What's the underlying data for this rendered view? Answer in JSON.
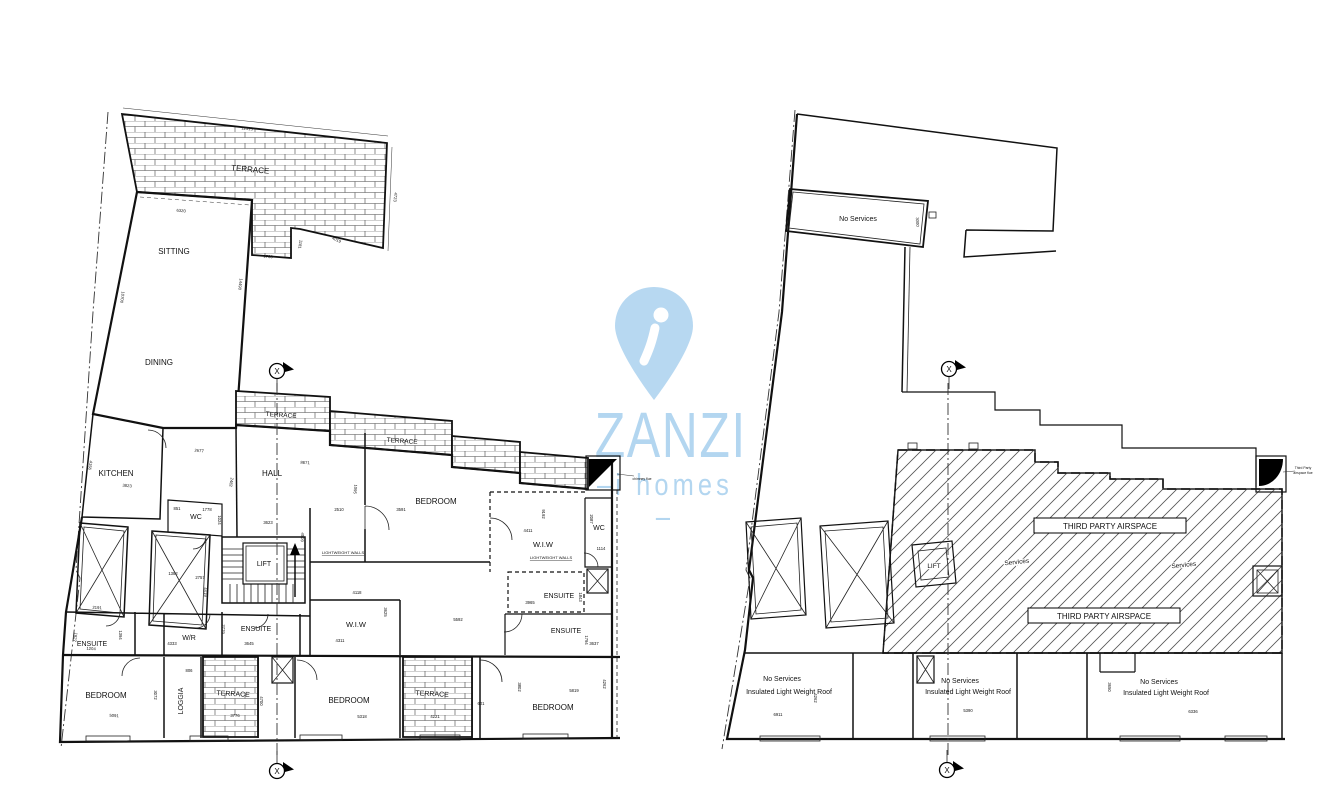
{
  "section_marker_label": "X",
  "watermark": {
    "brand": "ZANZI",
    "tagline_left": "–i",
    "tagline_word": "homes",
    "tagline_right": "–",
    "color": "#b3d6f0"
  },
  "left_plan": {
    "title": "penthouse floor plan",
    "rooms": [
      {
        "label": "TERRACE",
        "x": 250,
        "y": 172,
        "fs": 8,
        "rot": 5
      },
      {
        "label": "SITTING",
        "x": 174,
        "y": 254,
        "fs": 8
      },
      {
        "label": "DINING",
        "x": 159,
        "y": 365,
        "fs": 8
      },
      {
        "label": "KITCHEN",
        "x": 116,
        "y": 476,
        "fs": 8
      },
      {
        "label": "WC",
        "x": 196,
        "y": 519,
        "fs": 7
      },
      {
        "label": "HALL",
        "x": 272,
        "y": 476,
        "fs": 8
      },
      {
        "label": "LIFT",
        "x": 264,
        "y": 566,
        "fs": 7
      },
      {
        "label": "TERRACE",
        "x": 281,
        "y": 417,
        "fs": 6.5,
        "rot": 4
      },
      {
        "label": "TERRACE",
        "x": 402,
        "y": 443,
        "fs": 6.5,
        "rot": 4
      },
      {
        "label": "BEDROOM",
        "x": 436,
        "y": 504,
        "fs": 8
      },
      {
        "label": "W.I.W",
        "x": 543,
        "y": 547,
        "fs": 7.5
      },
      {
        "label": "WC",
        "x": 599,
        "y": 530,
        "fs": 7
      },
      {
        "label": "ENSUITE",
        "x": 559,
        "y": 598,
        "fs": 7
      },
      {
        "label": "ENSUITE",
        "x": 566,
        "y": 633,
        "fs": 7
      },
      {
        "label": "W.I.W",
        "x": 356,
        "y": 627,
        "fs": 7.5
      },
      {
        "label": "ENSUITE",
        "x": 256,
        "y": 631,
        "fs": 7
      },
      {
        "label": "W/R",
        "x": 189,
        "y": 640,
        "fs": 7
      },
      {
        "label": "ENSUITE",
        "x": 92,
        "y": 646,
        "fs": 7
      },
      {
        "label": "BEDROOM",
        "x": 106,
        "y": 698,
        "fs": 8
      },
      {
        "label": "LOGGIA",
        "x": 183,
        "y": 701,
        "fs": 7,
        "rot": -90
      },
      {
        "label": "TERRACE",
        "x": 233,
        "y": 696,
        "fs": 7,
        "rot": 3
      },
      {
        "label": "BEDROOM",
        "x": 349,
        "y": 703,
        "fs": 8
      },
      {
        "label": "TERRACE",
        "x": 432,
        "y": 696,
        "fs": 7,
        "rot": 3
      },
      {
        "label": "BEDROOM",
        "x": 553,
        "y": 710,
        "fs": 8
      }
    ],
    "tiny_labels": [
      {
        "label": "LIGHTWEIGHT WALLS",
        "x": 551,
        "y": 559,
        "fs": 4,
        "cls": "underline"
      },
      {
        "label": "LIGHTWEIGHT WALLS",
        "x": 343,
        "y": 554,
        "fs": 4,
        "cls": "underline"
      },
      {
        "label": "chimney flue",
        "x": 642,
        "y": 480,
        "fs": 3.4
      }
    ],
    "dimensions": [
      {
        "label": "12515",
        "x": 247,
        "y": 130,
        "rot": 5
      },
      {
        "label": "4723",
        "x": 394,
        "y": 197,
        "rot": 95
      },
      {
        "label": "6320",
        "x": 181,
        "y": 212,
        "rot": 5
      },
      {
        "label": "14490",
        "x": 239,
        "y": 284,
        "rot": 97
      },
      {
        "label": "10700",
        "x": 121,
        "y": 297,
        "rot": 98
      },
      {
        "label": "1730",
        "x": 268,
        "y": 258,
        "rot": 4
      },
      {
        "label": "1181",
        "x": 299,
        "y": 244,
        "rot": 100
      },
      {
        "label": "4019",
        "x": 336,
        "y": 241,
        "rot": 25
      },
      {
        "label": "2677",
        "x": 199,
        "y": 452,
        "rot": 5
      },
      {
        "label": "2482",
        "x": 230,
        "y": 482,
        "rot": 100
      },
      {
        "label": "8671",
        "x": 305,
        "y": 464,
        "rot": 3
      },
      {
        "label": "1095",
        "x": 354,
        "y": 489,
        "rot": 95
      },
      {
        "label": "2510",
        "x": 339,
        "y": 511
      },
      {
        "label": "3591",
        "x": 401,
        "y": 511
      },
      {
        "label": "9192",
        "x": 542,
        "y": 514,
        "rot": 90
      },
      {
        "label": "4411",
        "x": 528,
        "y": 532
      },
      {
        "label": "2087",
        "x": 590,
        "y": 519,
        "rot": 90
      },
      {
        "label": "1114",
        "x": 601,
        "y": 550
      },
      {
        "label": "851",
        "x": 177,
        "y": 510
      },
      {
        "label": "1778",
        "x": 207,
        "y": 511
      },
      {
        "label": "1024",
        "x": 218,
        "y": 520,
        "rot": 90
      },
      {
        "label": "3623",
        "x": 268,
        "y": 524
      },
      {
        "label": "4509",
        "x": 301,
        "y": 537,
        "rot": 93
      },
      {
        "label": "3823",
        "x": 127,
        "y": 487,
        "rot": 5
      },
      {
        "label": "4156",
        "x": 89,
        "y": 465,
        "rot": 100
      },
      {
        "label": "1382",
        "x": 173,
        "y": 575
      },
      {
        "label": "2757",
        "x": 200,
        "y": 579
      },
      {
        "label": "4419",
        "x": 204,
        "y": 592,
        "rot": 90
      },
      {
        "label": "2191",
        "x": 97,
        "y": 609,
        "rot": 3
      },
      {
        "label": "1827",
        "x": 74,
        "y": 637,
        "rot": 100
      },
      {
        "label": "1394",
        "x": 119,
        "y": 635,
        "rot": 90
      },
      {
        "label": "4333",
        "x": 172,
        "y": 645
      },
      {
        "label": "3645",
        "x": 249,
        "y": 645
      },
      {
        "label": "2779",
        "x": 222,
        "y": 629,
        "rot": 92
      },
      {
        "label": "4311",
        "x": 340,
        "y": 642
      },
      {
        "label": "4118",
        "x": 357,
        "y": 594
      },
      {
        "label": "3625",
        "x": 384,
        "y": 612,
        "rot": 90
      },
      {
        "label": "5592",
        "x": 458,
        "y": 621
      },
      {
        "label": "3965",
        "x": 530,
        "y": 604
      },
      {
        "label": "1843",
        "x": 579,
        "y": 597,
        "rot": 90
      },
      {
        "label": "1794",
        "x": 585,
        "y": 640,
        "rot": 90
      },
      {
        "label": "3637",
        "x": 594,
        "y": 645
      },
      {
        "label": "5819",
        "x": 574,
        "y": 692
      },
      {
        "label": "3802",
        "x": 518,
        "y": 687,
        "rot": 90
      },
      {
        "label": "4262",
        "x": 603,
        "y": 684,
        "rot": 90
      },
      {
        "label": "5091",
        "x": 114,
        "y": 717,
        "rot": 3
      },
      {
        "label": "1204",
        "x": 91,
        "y": 650,
        "rot": 3
      },
      {
        "label": "3072",
        "x": 154,
        "y": 695,
        "rot": 90
      },
      {
        "label": "806",
        "x": 189,
        "y": 672
      },
      {
        "label": "3776",
        "x": 235,
        "y": 717
      },
      {
        "label": "601",
        "x": 481,
        "y": 705
      },
      {
        "label": "4221",
        "x": 435,
        "y": 718
      },
      {
        "label": "4700",
        "x": 260,
        "y": 701,
        "rot": 90
      },
      {
        "label": "5318",
        "x": 362,
        "y": 718
      }
    ]
  },
  "right_plan": {
    "title": "roof / airspace plan",
    "rooms": [
      {
        "label": "No Services",
        "x": 858,
        "y": 221,
        "fs": 7
      },
      {
        "label": "Services",
        "x": 1017,
        "y": 564,
        "fs": 6.5,
        "rot": -6,
        "cls": "halo"
      },
      {
        "label": "Services",
        "x": 1184,
        "y": 567,
        "fs": 6.5,
        "rot": -6,
        "cls": "halo"
      },
      {
        "label": "LIFT",
        "x": 934,
        "y": 568,
        "fs": 6.5,
        "cls": "halo"
      },
      {
        "label": "No Services",
        "x": 782,
        "y": 681,
        "fs": 7
      },
      {
        "label": "Insulated Light Weight Roof",
        "x": 789,
        "y": 694,
        "fs": 7
      },
      {
        "label": "No Services",
        "x": 960,
        "y": 683,
        "fs": 7
      },
      {
        "label": "Insulated Light Weight Roof",
        "x": 968,
        "y": 694,
        "fs": 7
      },
      {
        "label": "No Services",
        "x": 1159,
        "y": 684,
        "fs": 7
      },
      {
        "label": "Insulated Light Weight Roof",
        "x": 1166,
        "y": 695,
        "fs": 7
      }
    ],
    "airspace_boxes": [
      {
        "label": "THIRD PARTY AIRSPACE"
      },
      {
        "label": "THIRD PARTY AIRSPACE"
      }
    ],
    "tiny_labels": [
      {
        "label": "Third Party",
        "x": 1303,
        "y": 469,
        "fs": 3.4
      },
      {
        "label": "airspace flue",
        "x": 1303,
        "y": 474,
        "fs": 3.4
      }
    ],
    "dimensions": [
      {
        "label": "3000",
        "x": 916,
        "y": 222,
        "rot": 88
      },
      {
        "label": "6911",
        "x": 778,
        "y": 716
      },
      {
        "label": "5390",
        "x": 968,
        "y": 712
      },
      {
        "label": "6336",
        "x": 1193,
        "y": 713
      },
      {
        "label": "3650",
        "x": 1108,
        "y": 687,
        "rot": 90
      },
      {
        "label": "4262",
        "x": 814,
        "y": 698,
        "rot": 90
      }
    ]
  }
}
